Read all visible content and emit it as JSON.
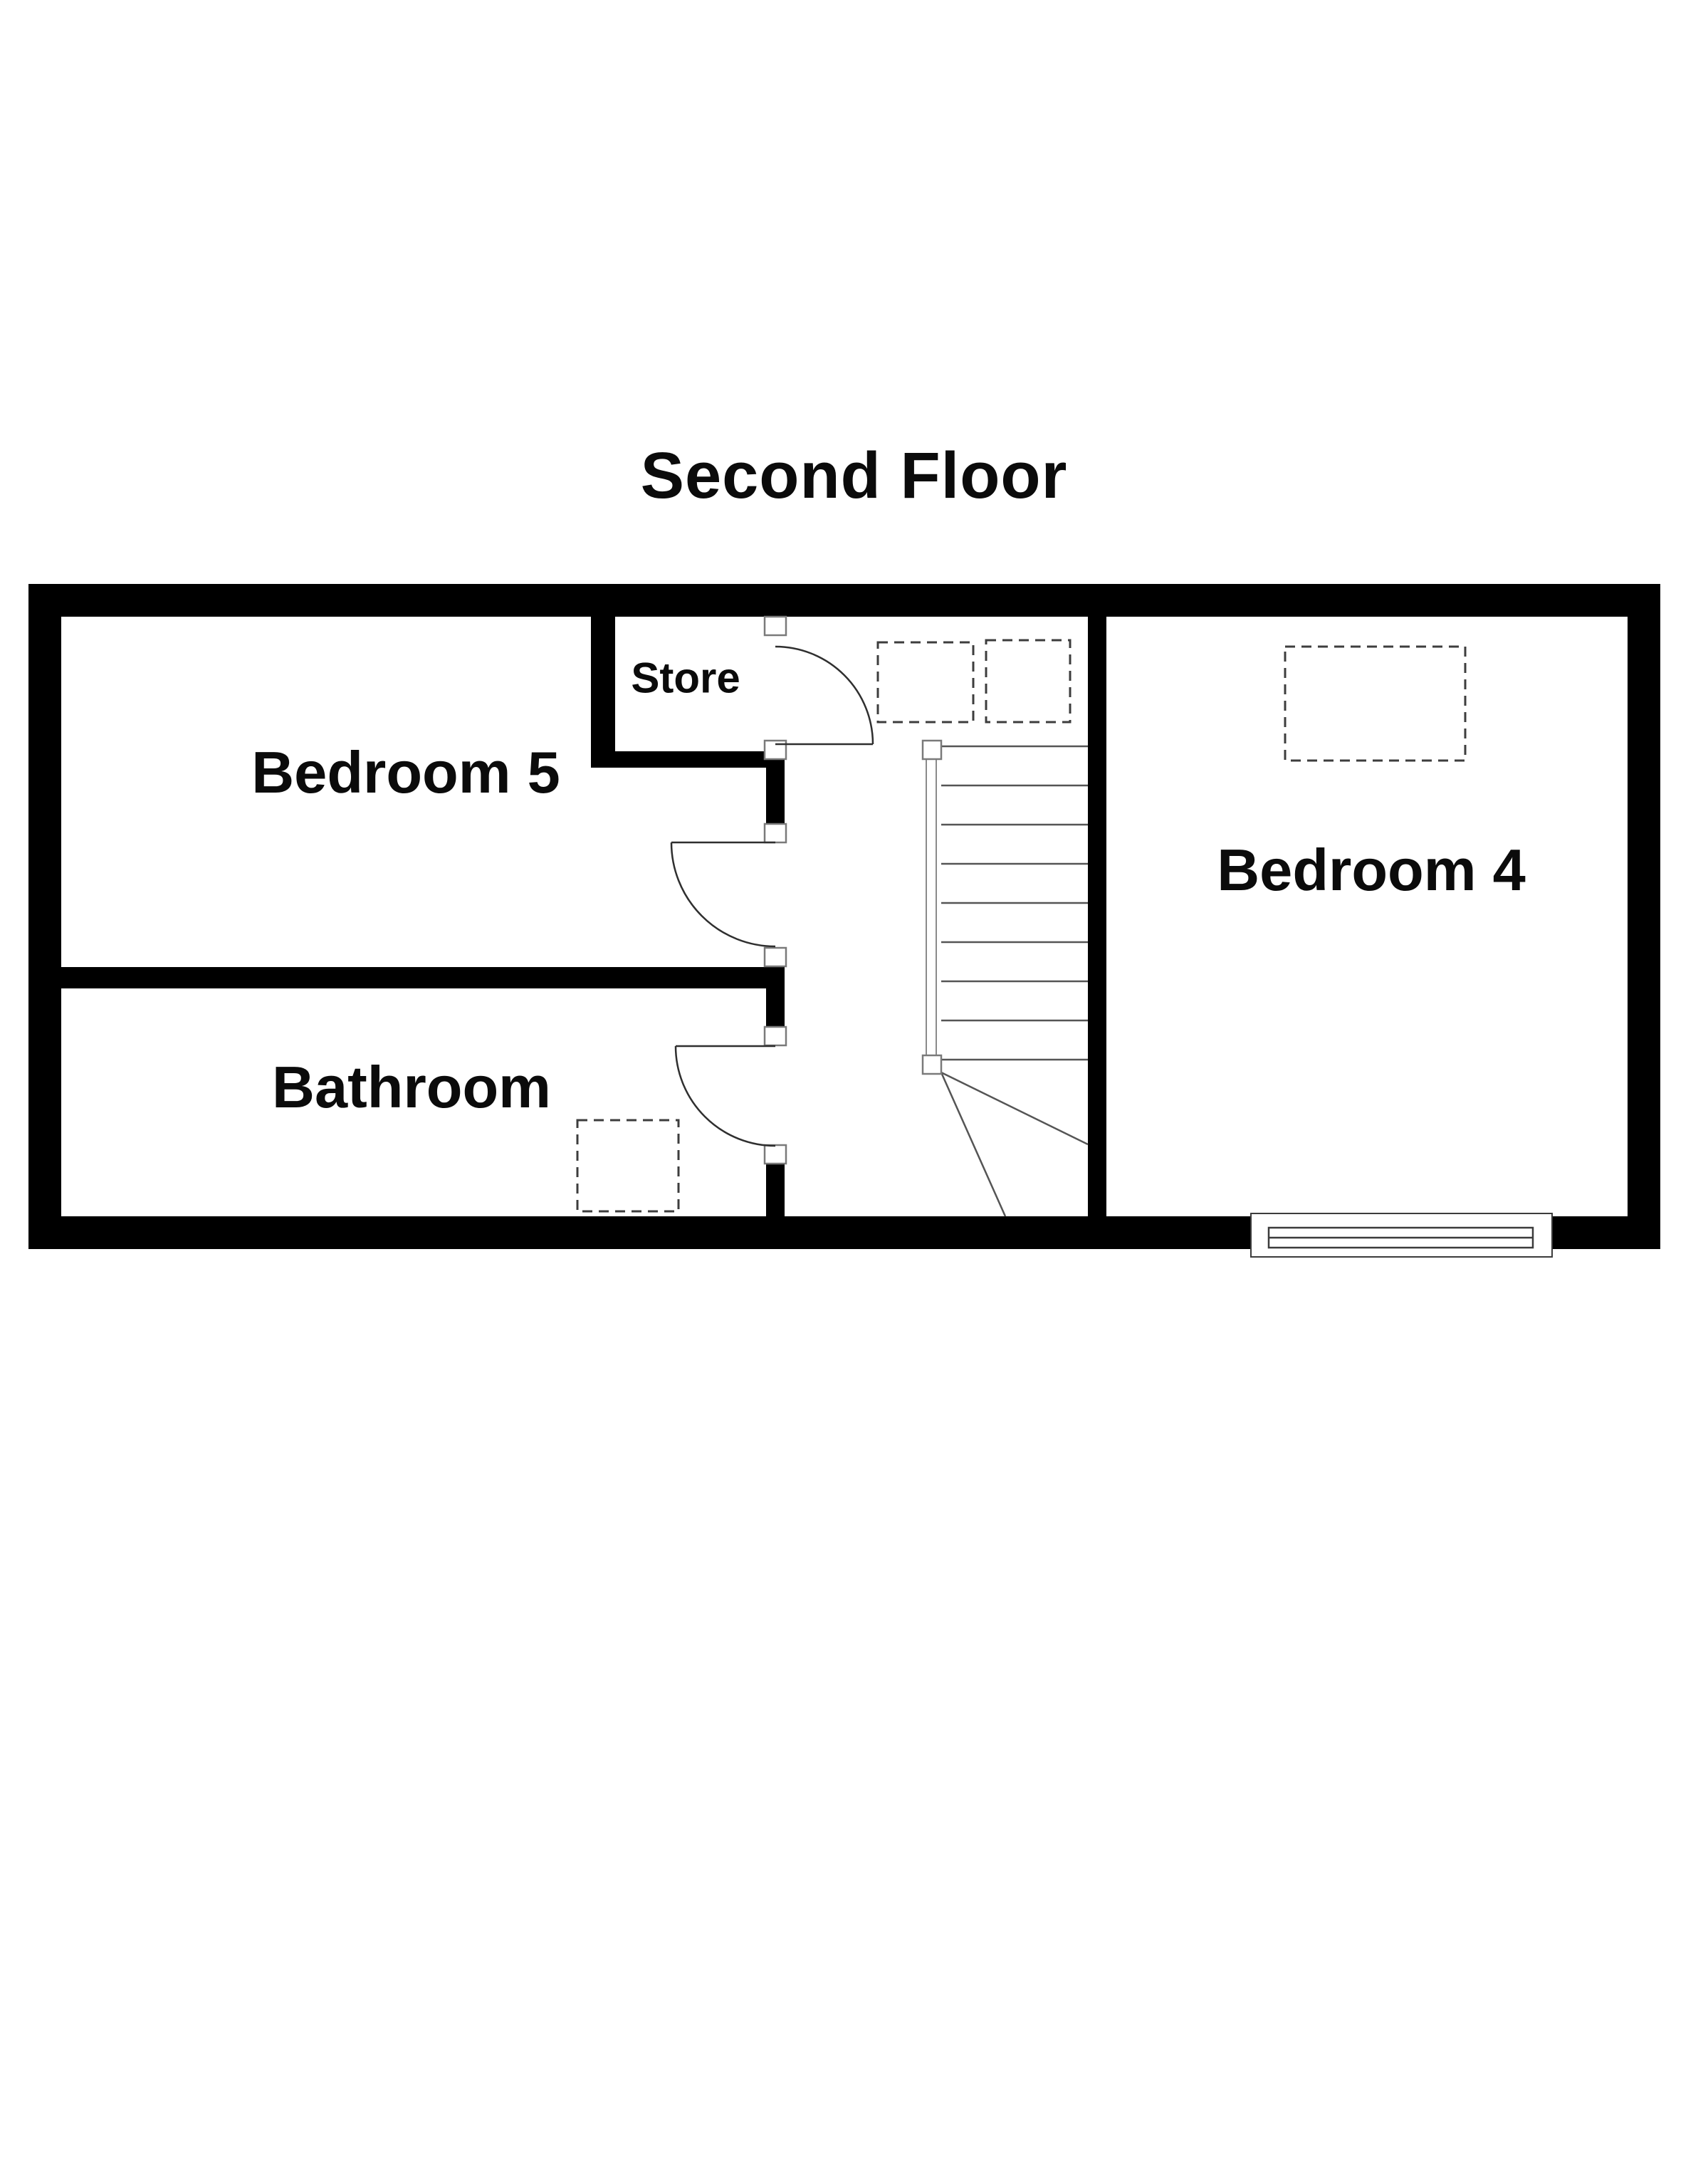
{
  "title": "Second Floor",
  "rooms": {
    "bedroom5": {
      "label": "Bedroom 5"
    },
    "store": {
      "label": "Store"
    },
    "bedroom4": {
      "label": "Bedroom 4"
    },
    "bathroom": {
      "label": "Bathroom"
    }
  },
  "plan": {
    "colors": {
      "wall": "#000000",
      "background": "#ffffff",
      "door_line": "#2f2f2f",
      "stair_line": "#555555",
      "dashed_outline": "#3d3d3d",
      "jamb_border": "#7a7a7a",
      "text": "#0b0b0b"
    },
    "stairs": {
      "tread_lines": 9,
      "winder_lines": 2,
      "newel_posts": 2,
      "orientation": "vertical-flight-with-bottom-winders"
    },
    "doors": [
      {
        "name": "store-door",
        "swing": "into-hallway"
      },
      {
        "name": "bedroom5-door",
        "swing": "into-bedroom5"
      },
      {
        "name": "bathroom-door",
        "swing": "into-bathroom"
      }
    ],
    "fixtures": {
      "hallway_dashed_squares": 2,
      "bedroom4_dashed_rectangles": 1,
      "bathroom_dashed_rectangles": 1
    },
    "window": {
      "name": "bedroom4-window",
      "location": "bottom-exterior-wall"
    }
  }
}
